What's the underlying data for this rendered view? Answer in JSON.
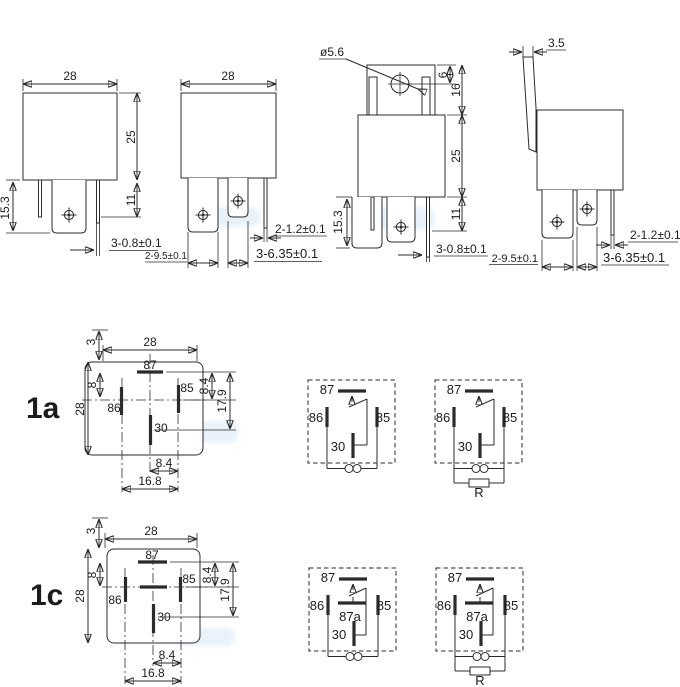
{
  "drawing": {
    "front_view": {
      "w": "28",
      "h": "25",
      "pin_h": "15.3",
      "pin_d": "11",
      "pin_t": "3-0.8±0.1"
    },
    "front_view_2": {
      "w": "28",
      "thin": "2-1.2±0.1",
      "wide": "2-9.5±0.1",
      "mid": "3-6.35±0.1"
    },
    "side_view": {
      "hole": "ø5.6",
      "hole_off": "6",
      "tab_h": "16",
      "h": "25",
      "pin_d": "11",
      "pin_h": "15.3",
      "pin_t": "3-0.8±0.1"
    },
    "side_view_2": {
      "tab_w": "3.5",
      "thin": "2-1.2±0.1",
      "wide": "2-9.5±0.1",
      "mid": "3-6.35±0.1"
    }
  },
  "form_1a": {
    "label": "1a",
    "dims": {
      "edge": "3",
      "w": "28",
      "h": "28",
      "row": "8",
      "right_a": "8.4",
      "right_b": "17.9",
      "bottom_a": "8.4",
      "bottom_b": "16.8"
    },
    "pins": {
      "p87": "87",
      "p86": "86",
      "p85": "85",
      "p30": "30"
    }
  },
  "form_1c": {
    "label": "1c",
    "dims": {
      "edge": "3",
      "w": "28",
      "h": "28",
      "row": "8",
      "right_a": "8.4",
      "right_b": "17.9",
      "bottom_a": "8.4",
      "bottom_b": "16.8"
    },
    "pins": {
      "p87": "87",
      "p86": "86",
      "p85": "85",
      "p30": "30"
    }
  },
  "schematic_1a": {
    "plain": {
      "p87": "87",
      "p86": "86",
      "p85": "85",
      "p30": "30"
    },
    "with_resistor": {
      "p87": "87",
      "p86": "86",
      "p85": "85",
      "p30": "30",
      "r": "R"
    }
  },
  "schematic_1c": {
    "plain": {
      "p87": "87",
      "p87a": "87a",
      "p86": "86",
      "p85": "85",
      "p30": "30"
    },
    "with_resistor": {
      "p87": "87",
      "p87a": "87a",
      "p86": "86",
      "p85": "85",
      "p30": "30",
      "r": "R"
    }
  }
}
